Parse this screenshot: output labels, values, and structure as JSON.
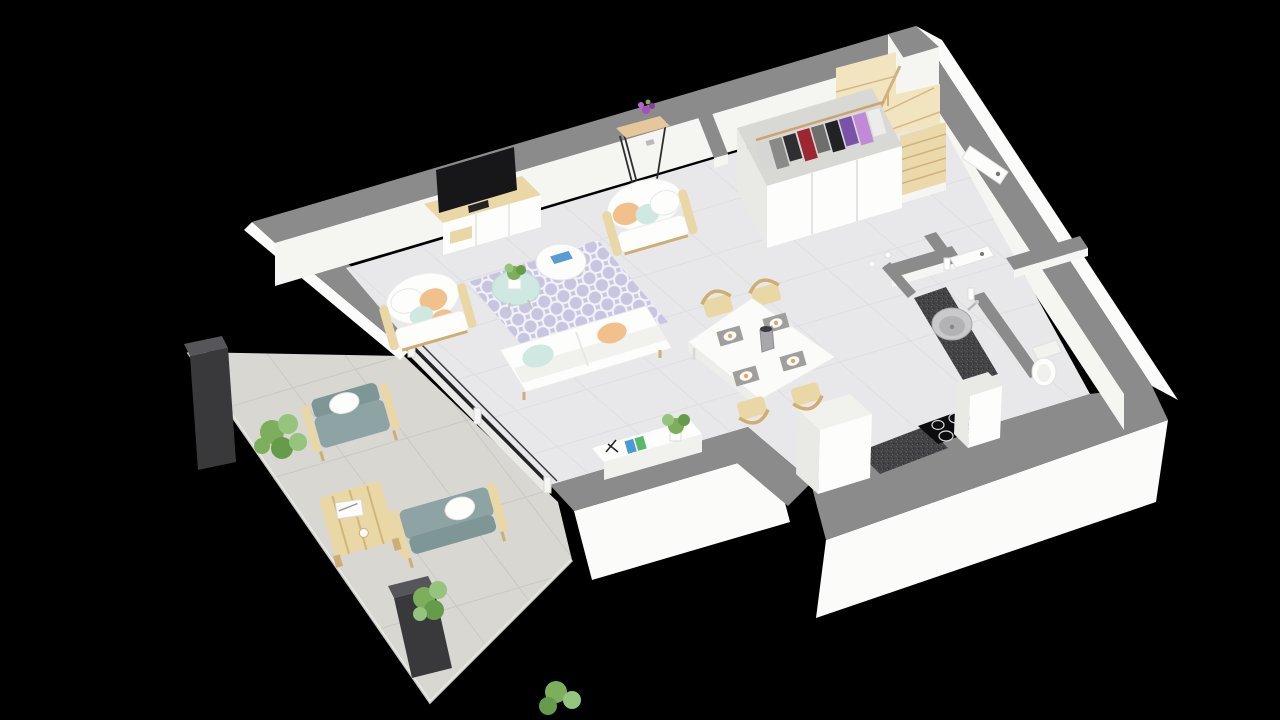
{
  "scene": {
    "description": "3D cutaway floor plan render of a one-level apartment with terrace, viewed from above at an angle, on a black background",
    "rooms": [
      "living-room",
      "dining-area",
      "kitchen",
      "wc",
      "entrance-hall",
      "staircase",
      "wardrobe-closet",
      "terrace"
    ]
  },
  "palette": {
    "background": "#000000",
    "wallTop": "#8b8b8b",
    "wallOuter": "#fbfbfa",
    "wallInner": "#f5f5f1",
    "floor": "#e8e8ea",
    "floorLine": "#dcdcdf",
    "terrace": "#d8d7d2",
    "terraceLine": "#c8c7c2",
    "white": "#fdfdfc",
    "offWhite": "#f1f1ee",
    "shadowWhite": "#e9e9e6",
    "wood": "#ead7a6",
    "woodDark": "#cfae74",
    "stair": "#ecd9ab",
    "stairLight": "#f2e4bf",
    "dark": "#39393c",
    "darkTop": "#55555a",
    "tv": "#17171a",
    "graniteBase": "#414143",
    "mint": "#cfe9e2",
    "peach": "#f2c08b",
    "rug": "#c8c5e0",
    "rugLine": "#f2f1f7",
    "plant": "#7cae5c",
    "plantLight": "#95c47c",
    "plantDark": "#659b4b",
    "outdoorCushion": "#8da3a4",
    "outdoorCushionDark": "#7f9697",
    "glass": "#232326",
    "blueBook": "#4a9bd5",
    "greenBook": "#57b86a"
  },
  "wardrobe": {
    "clothes": [
      {
        "item": "garment",
        "color": "#d6d6d4"
      },
      {
        "item": "garment",
        "color": "#8a8a88"
      },
      {
        "item": "garment",
        "color": "#2f2f31"
      },
      {
        "item": "garment",
        "color": "#9c2733"
      },
      {
        "item": "garment",
        "color": "#6e6e6c"
      },
      {
        "item": "garment",
        "color": "#222224"
      },
      {
        "item": "garment",
        "color": "#7b52a8"
      },
      {
        "item": "garment",
        "color": "#c08ad6"
      },
      {
        "item": "garment",
        "color": "#ececea"
      }
    ]
  },
  "inventory": {
    "living_room": [
      "tv",
      "tv-stand",
      "sofa",
      "armchair",
      "armchair",
      "round-coffee-table-mint",
      "round-coffee-table-white",
      "succulent-plant",
      "magazine",
      "trellis-rug",
      "sideboard",
      "console-table",
      "flower-vase"
    ],
    "dining_area": [
      "dining-table",
      "wood-chair",
      "wood-chair",
      "wood-chair",
      "wood-chair",
      "placemat-x4",
      "water-jug"
    ],
    "kitchen": [
      "island-cabinet",
      "granite-counter",
      "induction-cooktop",
      "tall-cabinet",
      "round-sink",
      "faucet"
    ],
    "wc": [
      "toilet",
      "door"
    ],
    "entrance": [
      "front-door",
      "wardrobe-with-clothes",
      "winder-staircase"
    ],
    "terrace": [
      "outdoor-armchair",
      "outdoor-sofa",
      "slatted-coffee-table",
      "shrub",
      "shrub",
      "shrub",
      "dark-pillar",
      "dark-pillar",
      "sliding-glass-door"
    ]
  }
}
